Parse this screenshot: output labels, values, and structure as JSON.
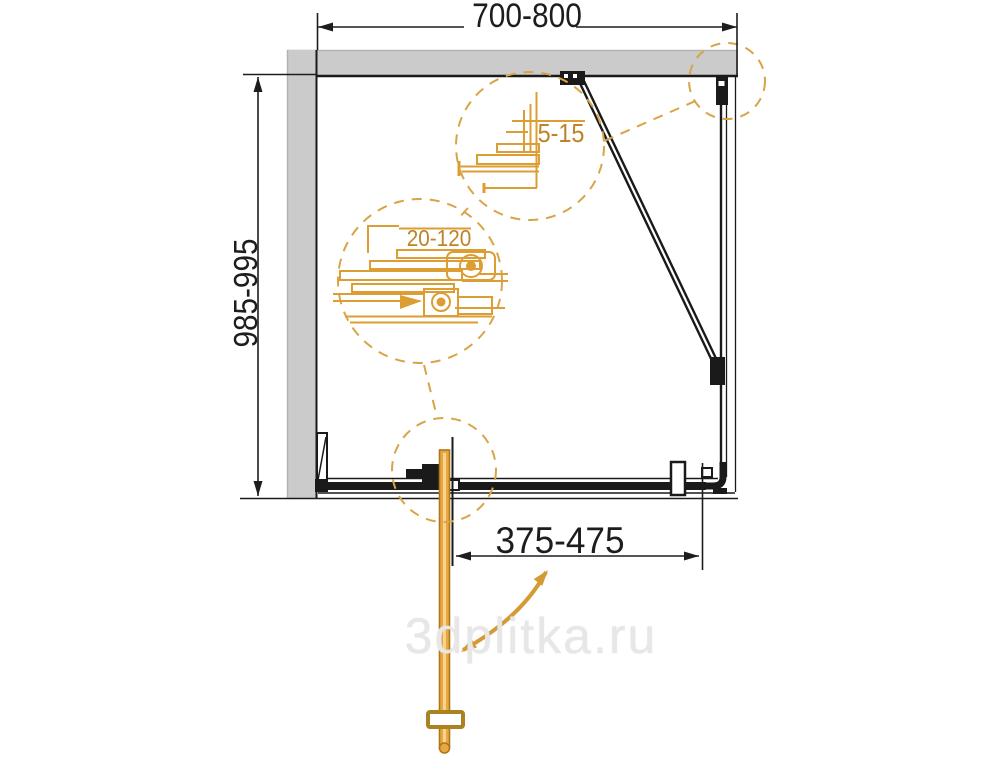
{
  "drawing": {
    "title": "shower-enclosure-plan-view",
    "dimensions": {
      "top_width": "700-800",
      "side_depth": "985-995",
      "door_width": "375-475",
      "detail_top_adjustment": "5-15",
      "detail_wall_adjustment": "20-120"
    },
    "watermark": "3dplitka.ru",
    "colors": {
      "detail_orange": "#DC9E33",
      "detail_text_orange": "#BC8426",
      "dashed_circle_orange": "#D9A447",
      "door_fill_orange": "#E7A93F",
      "wall_gray": "#CBCBCB",
      "line_black": "#1A1A1A",
      "watermark_gray": "#E7E7E7"
    }
  }
}
